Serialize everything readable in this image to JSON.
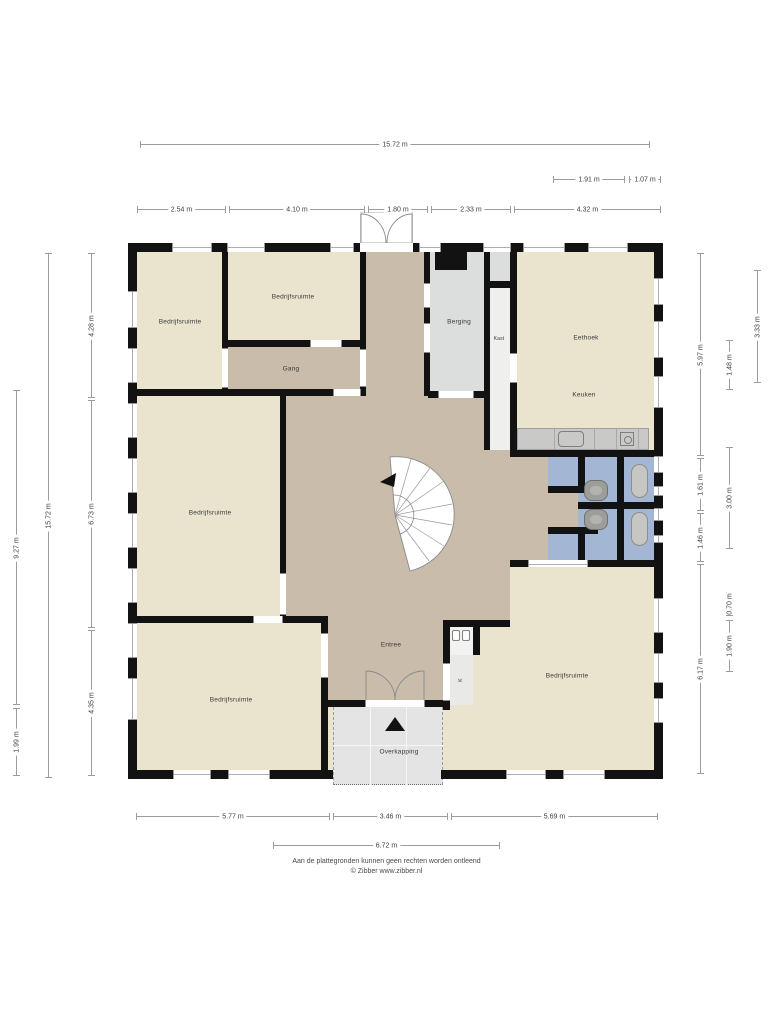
{
  "rooms": {
    "tl": "Bedrijfsruimte",
    "tm": "Bedrijfsruimte",
    "gang": "Gang",
    "berging": "Berging",
    "kast": "Kast",
    "eethoek": "Eethoek",
    "keuken": "Keuken",
    "ml": "Bedrijfsruimte",
    "entree": "Entree",
    "bl": "Bedrijfsruimte",
    "br": "Bedrijfsruimte",
    "overkapping": "Overkapping",
    "k_closet": "K"
  },
  "dims": {
    "top_total": "15.72 m",
    "top_191": "1.91 m",
    "top_107": "1.07 m",
    "top_254": "2.54 m",
    "top_410": "4.10 m",
    "top_180": "1.80 m",
    "top_233": "2.33 m",
    "top_432": "4.32 m",
    "left_927": "9.27 m",
    "left_199": "1.99 m",
    "left_total": "15.72 m",
    "left_428": "4.28 m",
    "left_673": "6.73 m",
    "left_435": "4.35 m",
    "right_597": "5.97 m",
    "right_161": "1.61 m",
    "right_146": "1.46 m",
    "right_617": "6.17 m",
    "right_148": "1.48 m",
    "right_300": "3.00 m",
    "right_070": "0.70 m",
    "right_190": "1.90 m",
    "right_333": "3.33 m",
    "bottom_577": "5.77 m",
    "bottom_346": "3.46 m",
    "bottom_569": "5.69 m",
    "bottom_672": "6.72 m"
  },
  "footer": {
    "line1": "Aan de plattegronden kunnen geen rechten worden ontleend",
    "line2": "© Zibber www.zibber.nl"
  },
  "colors": {
    "room": "#eae3ce",
    "hall": "#c9bcab",
    "storage": "#dcdddd",
    "closet": "#efefed",
    "bath": "#a3b6d4",
    "counter": "#c9c9c7",
    "canopy": "#e4e4e4",
    "wall": "#121212"
  }
}
